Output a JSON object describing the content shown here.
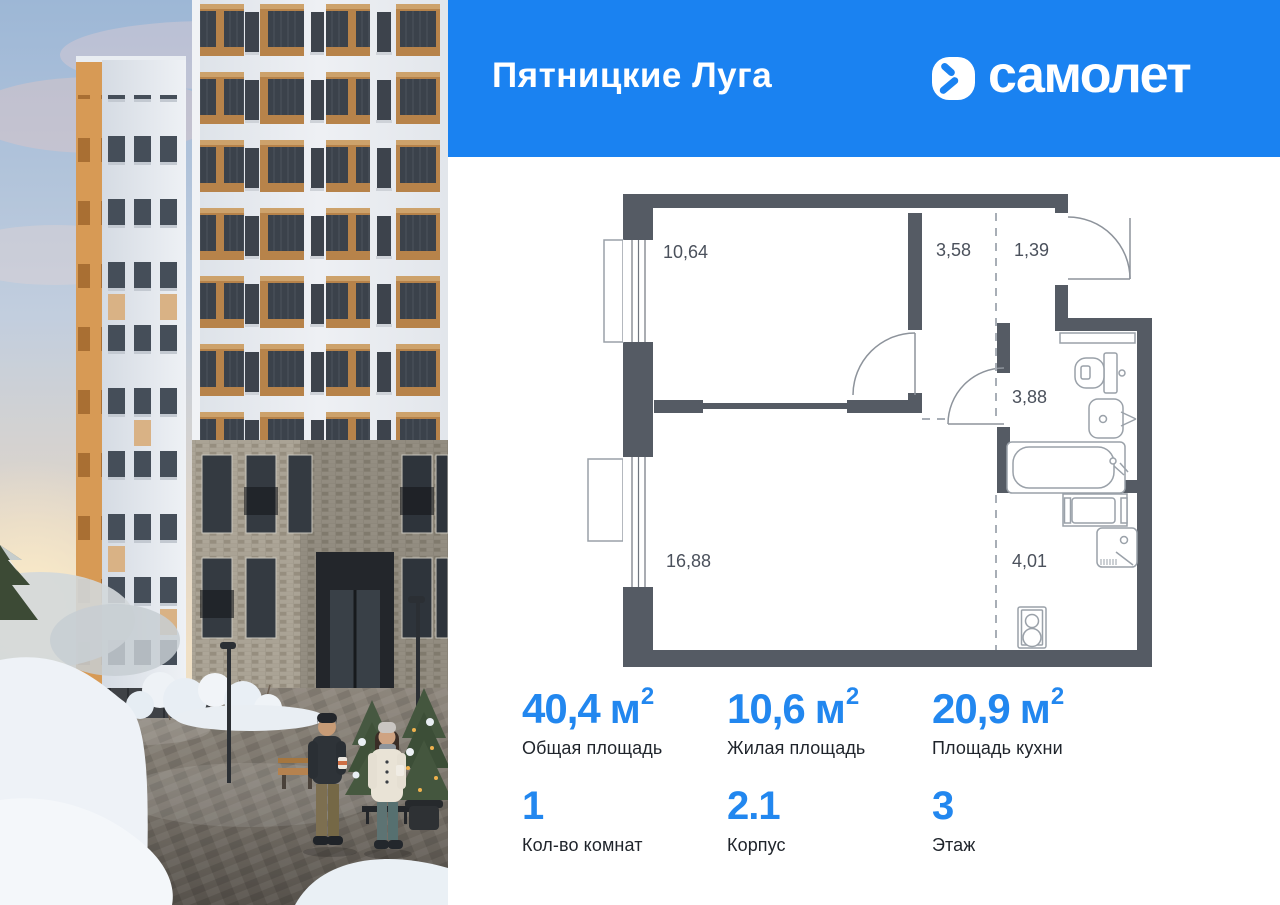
{
  "header": {
    "project_name": "Пятницкие Луга",
    "brand_name": "самолет",
    "brand_icon": "samolet-arrow-icon",
    "background_color": "#1a82f1"
  },
  "plan": {
    "wall_color": "#555b64",
    "rooms": [
      {
        "name": "bedroom",
        "area": "10,64"
      },
      {
        "name": "hallway",
        "area": "3,58"
      },
      {
        "name": "entry",
        "area": "1,39"
      },
      {
        "name": "bathroom",
        "area": "3,88"
      },
      {
        "name": "living-room",
        "area": "16,88"
      },
      {
        "name": "kitchen-zone",
        "area": "4,01"
      }
    ]
  },
  "stats": {
    "accent_color": "#2287ef",
    "row1": [
      {
        "value": "40,4",
        "unit": "м",
        "sup": "2",
        "label": "Общая площадь"
      },
      {
        "value": "10,6",
        "unit": "м",
        "sup": "2",
        "label": "Жилая площадь"
      },
      {
        "value": "20,9",
        "unit": "м",
        "sup": "2",
        "label": "Площадь кухни"
      }
    ],
    "row2": [
      {
        "value": "1",
        "label": "Кол-во комнат"
      },
      {
        "value": "2.1",
        "label": "Корпус"
      },
      {
        "value": "3",
        "label": "Этаж"
      }
    ]
  }
}
